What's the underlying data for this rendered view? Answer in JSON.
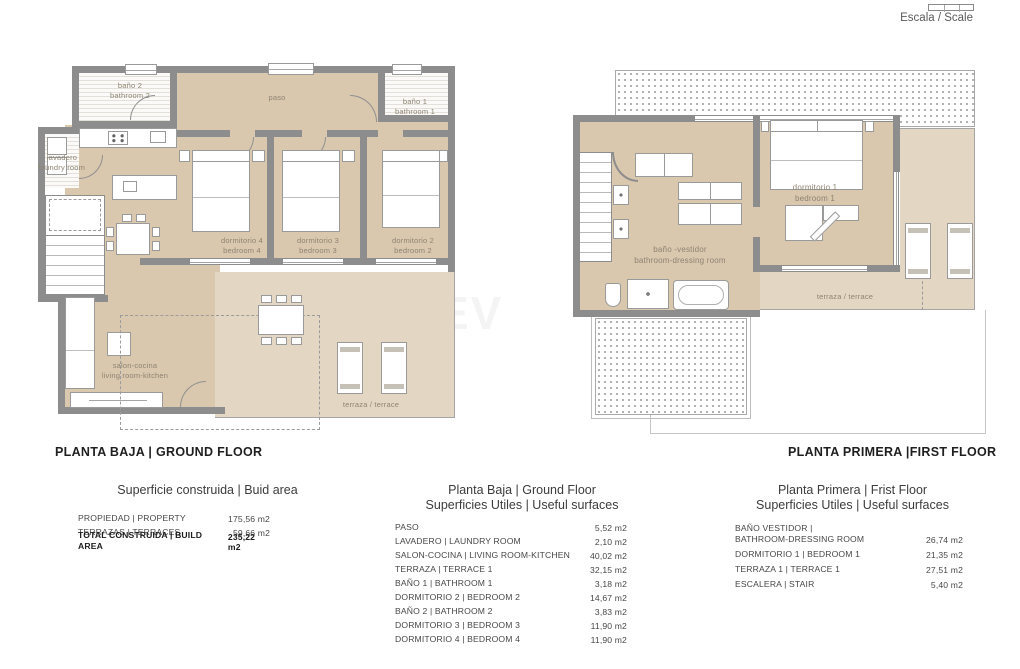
{
  "header": {
    "scale_label": "Escala / Scale"
  },
  "watermark": "EV",
  "colors": {
    "wall": "#8d8d8d",
    "floor": "#d9c7ae",
    "terrace": "#e3d7c4",
    "label": "#8e8473"
  },
  "ground_floor": {
    "title": "PLANTA BAJA | GROUND FLOOR",
    "rooms": {
      "bath2": "baño 2\nbathroom 2",
      "laundry": "lavadero\nlaundry room",
      "paso": "paso",
      "bath1": "baño 1\nbathroom 1",
      "bedroom4": "dormitorio 4\nbedroom 4",
      "bedroom3": "dormitorio 3\nbedroom 3",
      "bedroom2": "dormitorio 2\nbedroom 2",
      "living": "salon-cocina\nliving room-kitchen",
      "terrace": "terraza / terrace"
    }
  },
  "first_floor": {
    "title": "PLANTA PRIMERA |FIRST FLOOR",
    "rooms": {
      "bath_dressing": "baño -vestidor\nbathroom-dressing room",
      "bedroom1": "dormitorio 1\nbedroom 1",
      "terrace": "terraza / terrace"
    }
  },
  "tables": {
    "build_area": {
      "title": "Superficie construida | Buid area",
      "rows": [
        {
          "label": "PROPIEDAD | PROPERTY",
          "value": "175,56 m2"
        },
        {
          "label": "TERRAZAS | TERRACES",
          "value": "59,66 m2"
        },
        {
          "label": "TOTAL CONSTRUIDA | BUILD AREA",
          "value": "235,22 m2"
        }
      ]
    },
    "ground_surfaces": {
      "title_line1": "Planta Baja | Ground Floor",
      "title_line2": "Superficies Utiles | Useful surfaces",
      "rows": [
        {
          "label": "PASO",
          "value": "5,52 m2"
        },
        {
          "label": "LAVADERO | LAUNDRY ROOM",
          "value": "2,10 m2"
        },
        {
          "label": "SALON-COCINA | LIVING ROOM-KITCHEN",
          "value": "40,02 m2"
        },
        {
          "label": "TERRAZA | TERRACE 1",
          "value": "32,15 m2"
        },
        {
          "label": "BAÑO 1 | BATHROOM 1",
          "value": "3,18 m2"
        },
        {
          "label": "DORMITORIO 2 | BEDROOM 2",
          "value": "14,67 m2"
        },
        {
          "label": "BAÑO 2 | BATHROOM 2",
          "value": "3,83 m2"
        },
        {
          "label": "DORMITORIO 3 | BEDROOM 3",
          "value": "11,90 m2"
        },
        {
          "label": "DORMITORIO 4 | BEDROOM 4",
          "value": "11,90 m2"
        }
      ]
    },
    "first_surfaces": {
      "title_line1": "Planta Primera | Frist Floor",
      "title_line2": "Superficies Utiles | Useful surfaces",
      "rows": [
        {
          "label": "BAÑO VESTIDOR |\nBATHROOM-DRESSING ROOM",
          "value": "26,74 m2"
        },
        {
          "label": "DORMITORIO 1 | BEDROOM 1",
          "value": "21,35 m2"
        },
        {
          "label": "TERRAZA 1 | TERRACE 1",
          "value": "27,51 m2"
        },
        {
          "label": "ESCALERA | STAIR",
          "value": "5,40 m2"
        }
      ]
    }
  }
}
